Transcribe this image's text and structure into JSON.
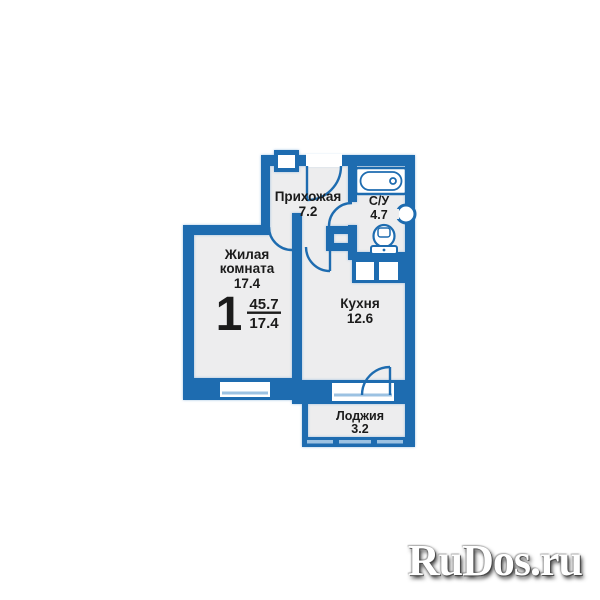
{
  "plan": {
    "summary": {
      "rooms_count": "1",
      "total_area": "45.7",
      "living_area": "17.4"
    },
    "rooms": {
      "living": {
        "label1": "Жилая",
        "label2": "комната",
        "area": "17.4"
      },
      "hallway": {
        "label": "Прихожая",
        "area": "7.2"
      },
      "bathroom": {
        "label": "С/У",
        "area": "4.7"
      },
      "kitchen": {
        "label": "Кухня",
        "area": "12.6"
      },
      "loggia": {
        "label": "Лоджия",
        "area": "3.2"
      }
    }
  },
  "watermark": {
    "text": "RuDos.ru"
  },
  "colors": {
    "wall_blue": "#1e6cb0",
    "floor_gray": "#ededee",
    "glass_blue": "#9cc2e2",
    "label_dark": "#1b1b1b",
    "background": "#ffffff"
  }
}
